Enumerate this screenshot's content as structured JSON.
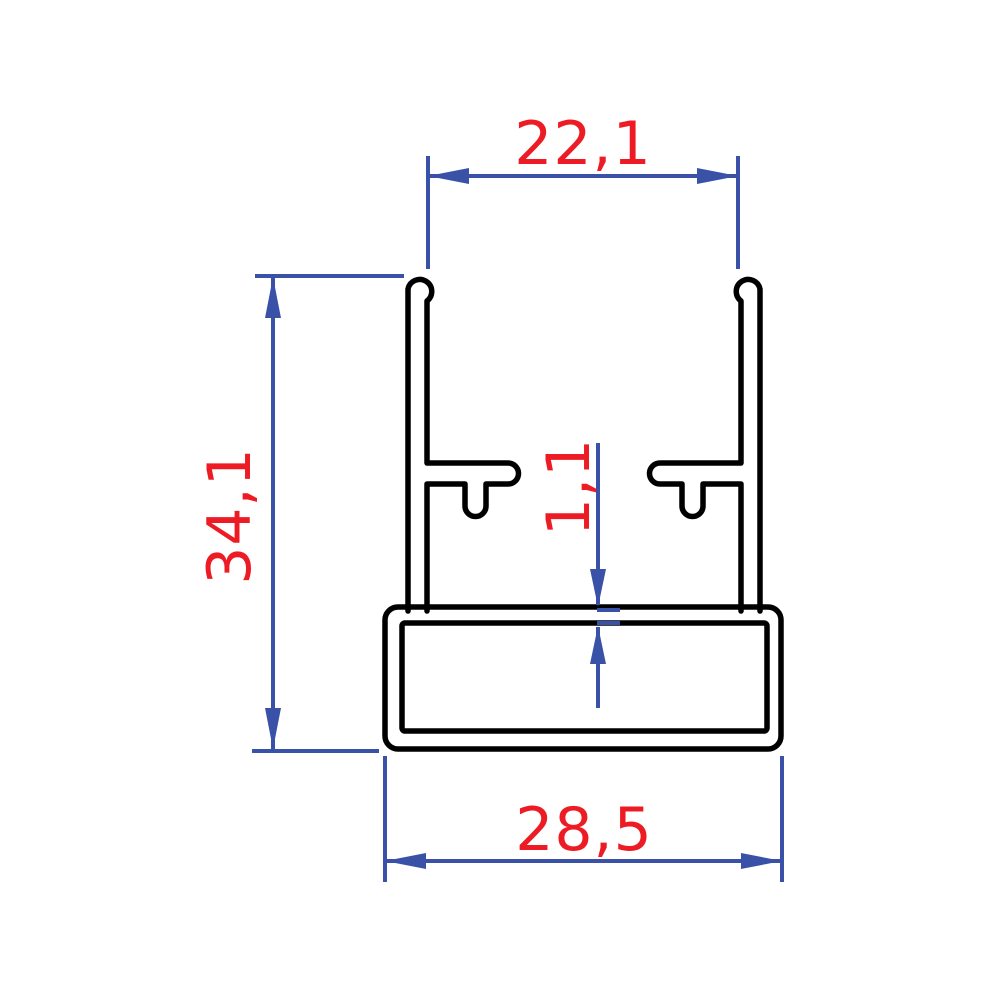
{
  "drawing": {
    "type": "technical-cross-section",
    "dimensions": {
      "top_inner_width": "22,1",
      "overall_height": "34,1",
      "base_wall_thickness": "1,1",
      "base_outer_width": "28,5"
    },
    "colors": {
      "profile_line": "#000000",
      "dimension_line": "#3a51a8",
      "dimension_text": "#ed1c24",
      "background": "#ffffff"
    }
  }
}
